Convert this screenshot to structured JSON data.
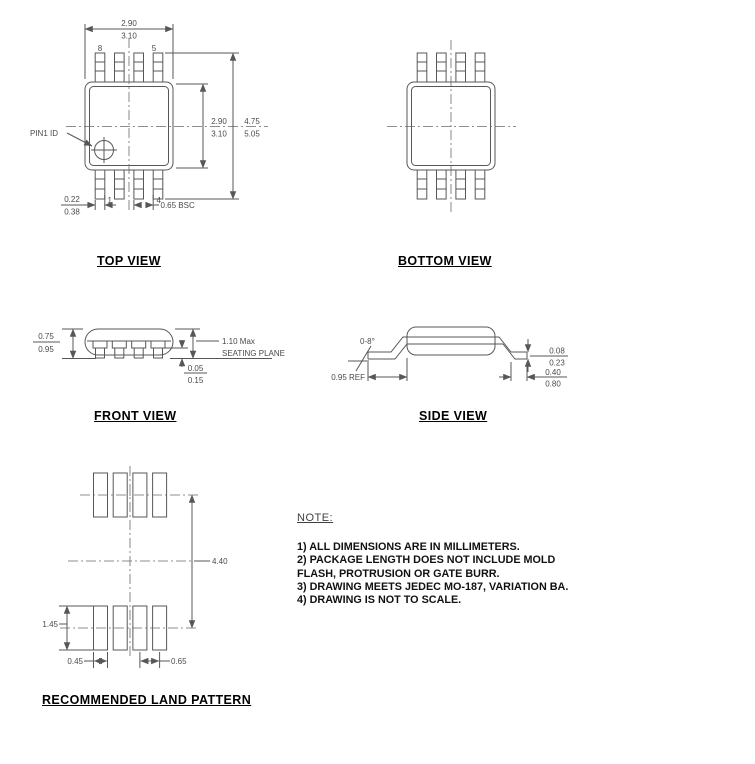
{
  "titles": {
    "top": "TOP VIEW",
    "bottom": "BOTTOM VIEW",
    "front": "FRONT VIEW",
    "side": "SIDE VIEW",
    "land": "RECOMMENDED LAND PATTERN"
  },
  "top_view": {
    "dim_width_min": "2.90",
    "dim_width_max": "3.10",
    "dim_body_min": "2.90",
    "dim_body_max": "3.10",
    "dim_overall_min": "4.75",
    "dim_overall_max": "5.05",
    "dim_lead_min": "0.22",
    "dim_lead_max": "0.38",
    "dim_pitch": "0.65 BSC",
    "pin1_id_label": "PIN1 ID",
    "pin8": "8",
    "pin5": "5",
    "pin1": "1",
    "pin4": "4"
  },
  "front_view": {
    "dim_lead_min": "0.75",
    "dim_lead_max": "0.95",
    "dim_height": "1.10 Max",
    "seating_plane": "SEATING PLANE",
    "dim_standoff_min": "0.05",
    "dim_standoff_max": "0.15"
  },
  "side_view": {
    "dim_angle": "0-8°",
    "dim_ref": "0.95 REF",
    "dim_thickness_min": "0.08",
    "dim_thickness_max": "0.23",
    "dim_foot_min": "0.40",
    "dim_foot_max": "0.80"
  },
  "land_pattern": {
    "dim_span": "4.40",
    "dim_pad_height": "1.45",
    "dim_pad_width": "0.45",
    "dim_pitch": "0.65"
  },
  "note": {
    "title": "NOTE:",
    "lines": [
      "1) ALL DIMENSIONS ARE IN MILLIMETERS.",
      "2) PACKAGE LENGTH DOES NOT INCLUDE MOLD",
      "FLASH, PROTRUSION OR GATE BURR.",
      "3) DRAWING MEETS JEDEC MO-187, VARIATION BA.",
      "4) DRAWING IS NOT TO SCALE."
    ]
  },
  "colors": {
    "line": "#575757",
    "dim_text": "#4a4a4a",
    "title_text": "#000000",
    "note_text": "#111111",
    "background": "#ffffff"
  }
}
